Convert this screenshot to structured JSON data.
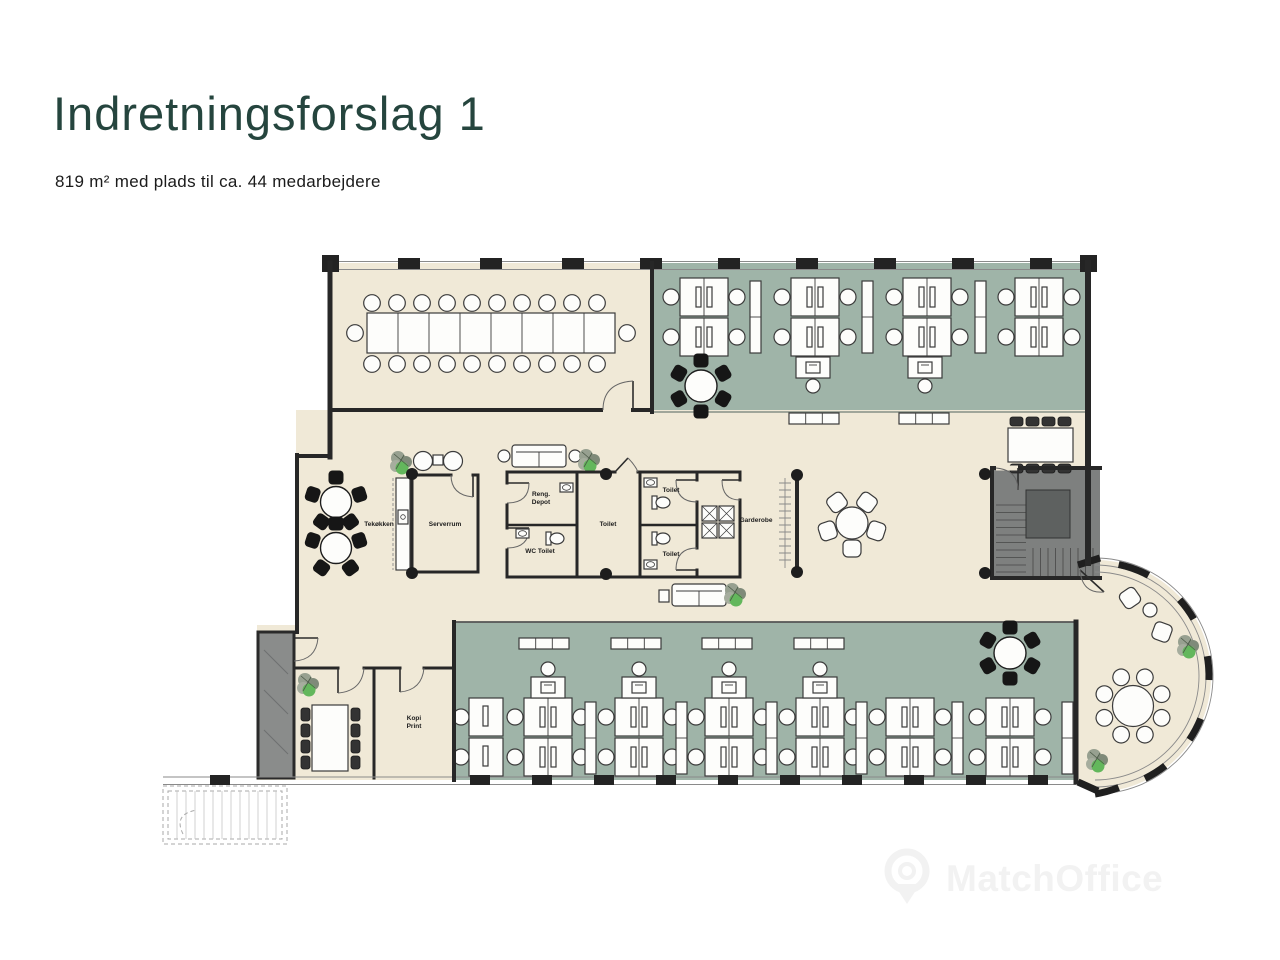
{
  "page": {
    "title": "Indretningsforslag 1",
    "subtitle": "819 m² med plads til ca. 44 medarbejdere"
  },
  "floorplan": {
    "labels": {
      "tekokken": "Tekøkken",
      "serverrum": "Serverrum",
      "reng_depot": [
        "Reng.",
        "Depot"
      ],
      "wc_toilet": "WC Toilet",
      "toilet_mid": "Toilet",
      "toilet_top": "Toilet",
      "toilet_bottom": "Toilet",
      "garderobe": "Garderobe",
      "kopi_print": [
        "Kopi",
        "Print"
      ]
    },
    "colors": {
      "floor_beige": "#f0e9d7",
      "zone_green": "#9fb4a8",
      "wall": "#272727",
      "stair_gray": "#7e807f",
      "plant_green": "#63b75c"
    }
  },
  "watermark": {
    "text": "MatchOffice",
    "icon": "map-pin-icon"
  }
}
